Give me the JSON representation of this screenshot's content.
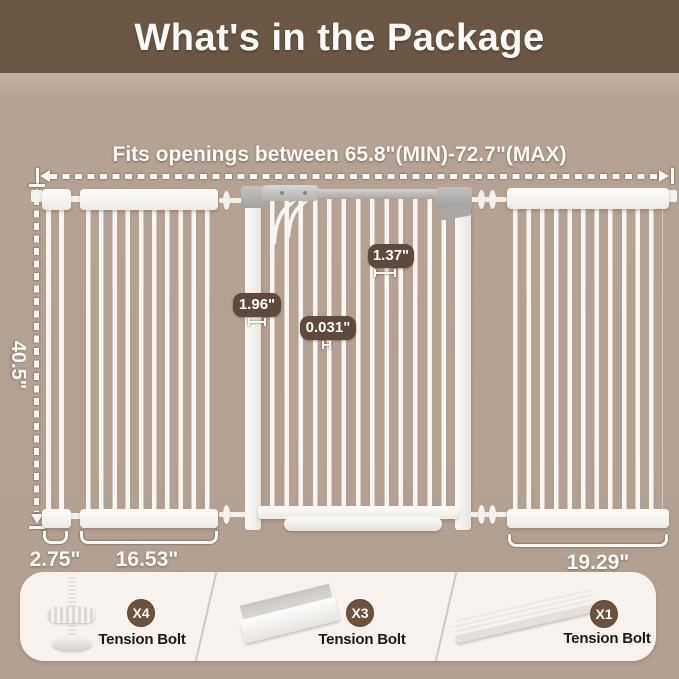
{
  "header": {
    "title": "What's in the Package"
  },
  "diagram": {
    "fits_label": "Fits openings between 65.8\"(MIN)-72.7\"(MAX)",
    "height_label": "40.5\"",
    "post_width_label": "1.96\"",
    "bar_gap_label": "1.37\"",
    "bar_thickness_label": "0.031\"",
    "width_small_label": "2.75\"",
    "width_left_label": "16.53\"",
    "width_right_label": "19.29\""
  },
  "package": {
    "items": [
      {
        "qty": "X4",
        "label": "Tension Bolt",
        "icon": "tension-bolt-screw-icon"
      },
      {
        "qty": "X3",
        "label": "Tension Bolt",
        "icon": "u-channel-bracket-icon"
      },
      {
        "qty": "X1",
        "label": "Tension Bolt",
        "icon": "threshold-ramp-icon"
      }
    ]
  },
  "colors": {
    "header_bg": "#6b5746",
    "canvas_bg": "#b2a092",
    "dim_badge_bg": "#5d4a3a",
    "qty_badge_bg": "#6d523e",
    "items_panel_bg": "#f7f2ee",
    "gate_white": "#f8f6f3",
    "text_light": "#fdfcfa",
    "text_dark": "#201913"
  }
}
